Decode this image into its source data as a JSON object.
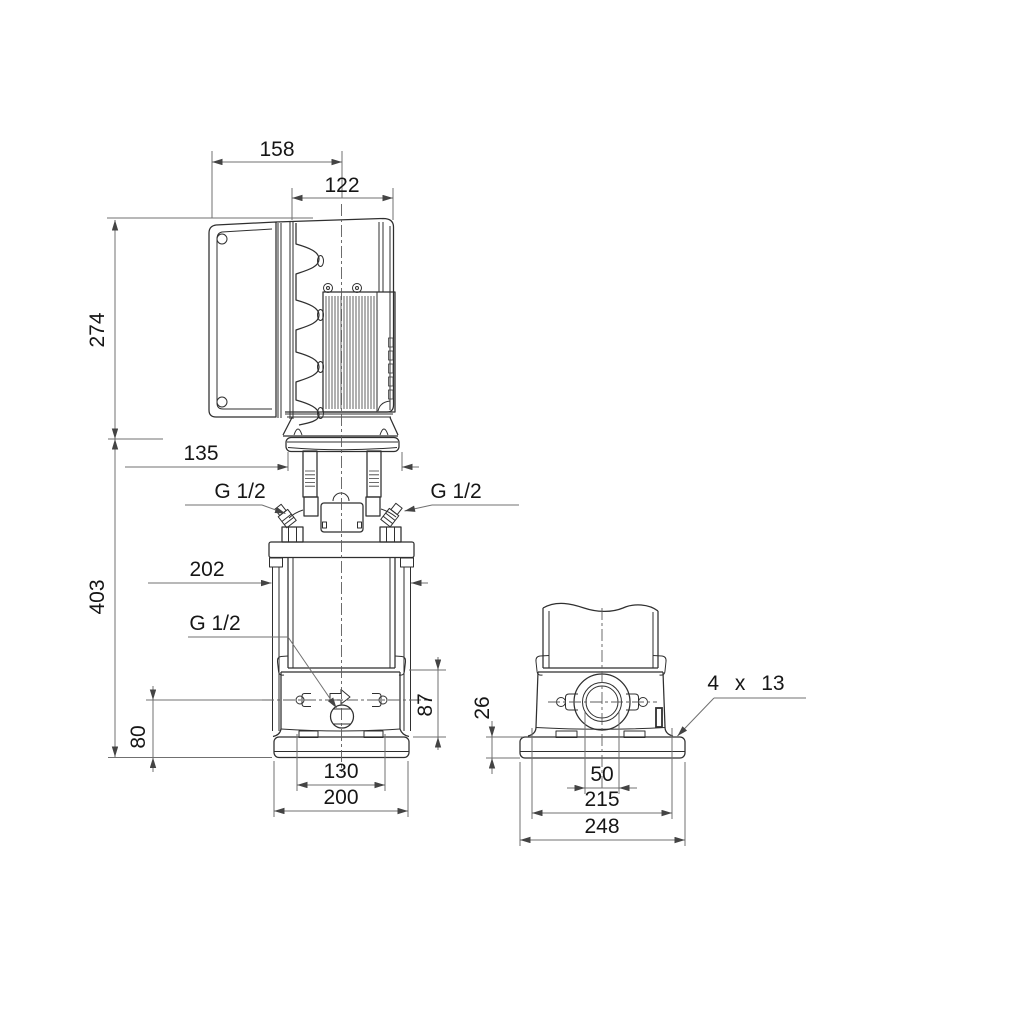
{
  "page": {
    "background": "#ffffff"
  },
  "drawing": {
    "line_color": "#2f2f2f",
    "dim_line_color": "#707070",
    "side_view": {
      "dims": {
        "converter_depth": "158",
        "motor_width": "122",
        "motor_height": "274",
        "head_width": "135",
        "pump_height": "403",
        "sleeve_width": "202",
        "outlet_height": "87",
        "port_height": "80",
        "foot_hole_pitch": "130",
        "foot_width": "200"
      },
      "ports": {
        "vent_left": "G 1/2",
        "vent_right": "G 1/2",
        "drain": "G 1/2"
      }
    },
    "end_view": {
      "dims": {
        "base_height": "26",
        "port_bore": "50",
        "bolt_pitch": "215",
        "base_length": "248",
        "bolt_holes": "4 x 13"
      }
    }
  }
}
